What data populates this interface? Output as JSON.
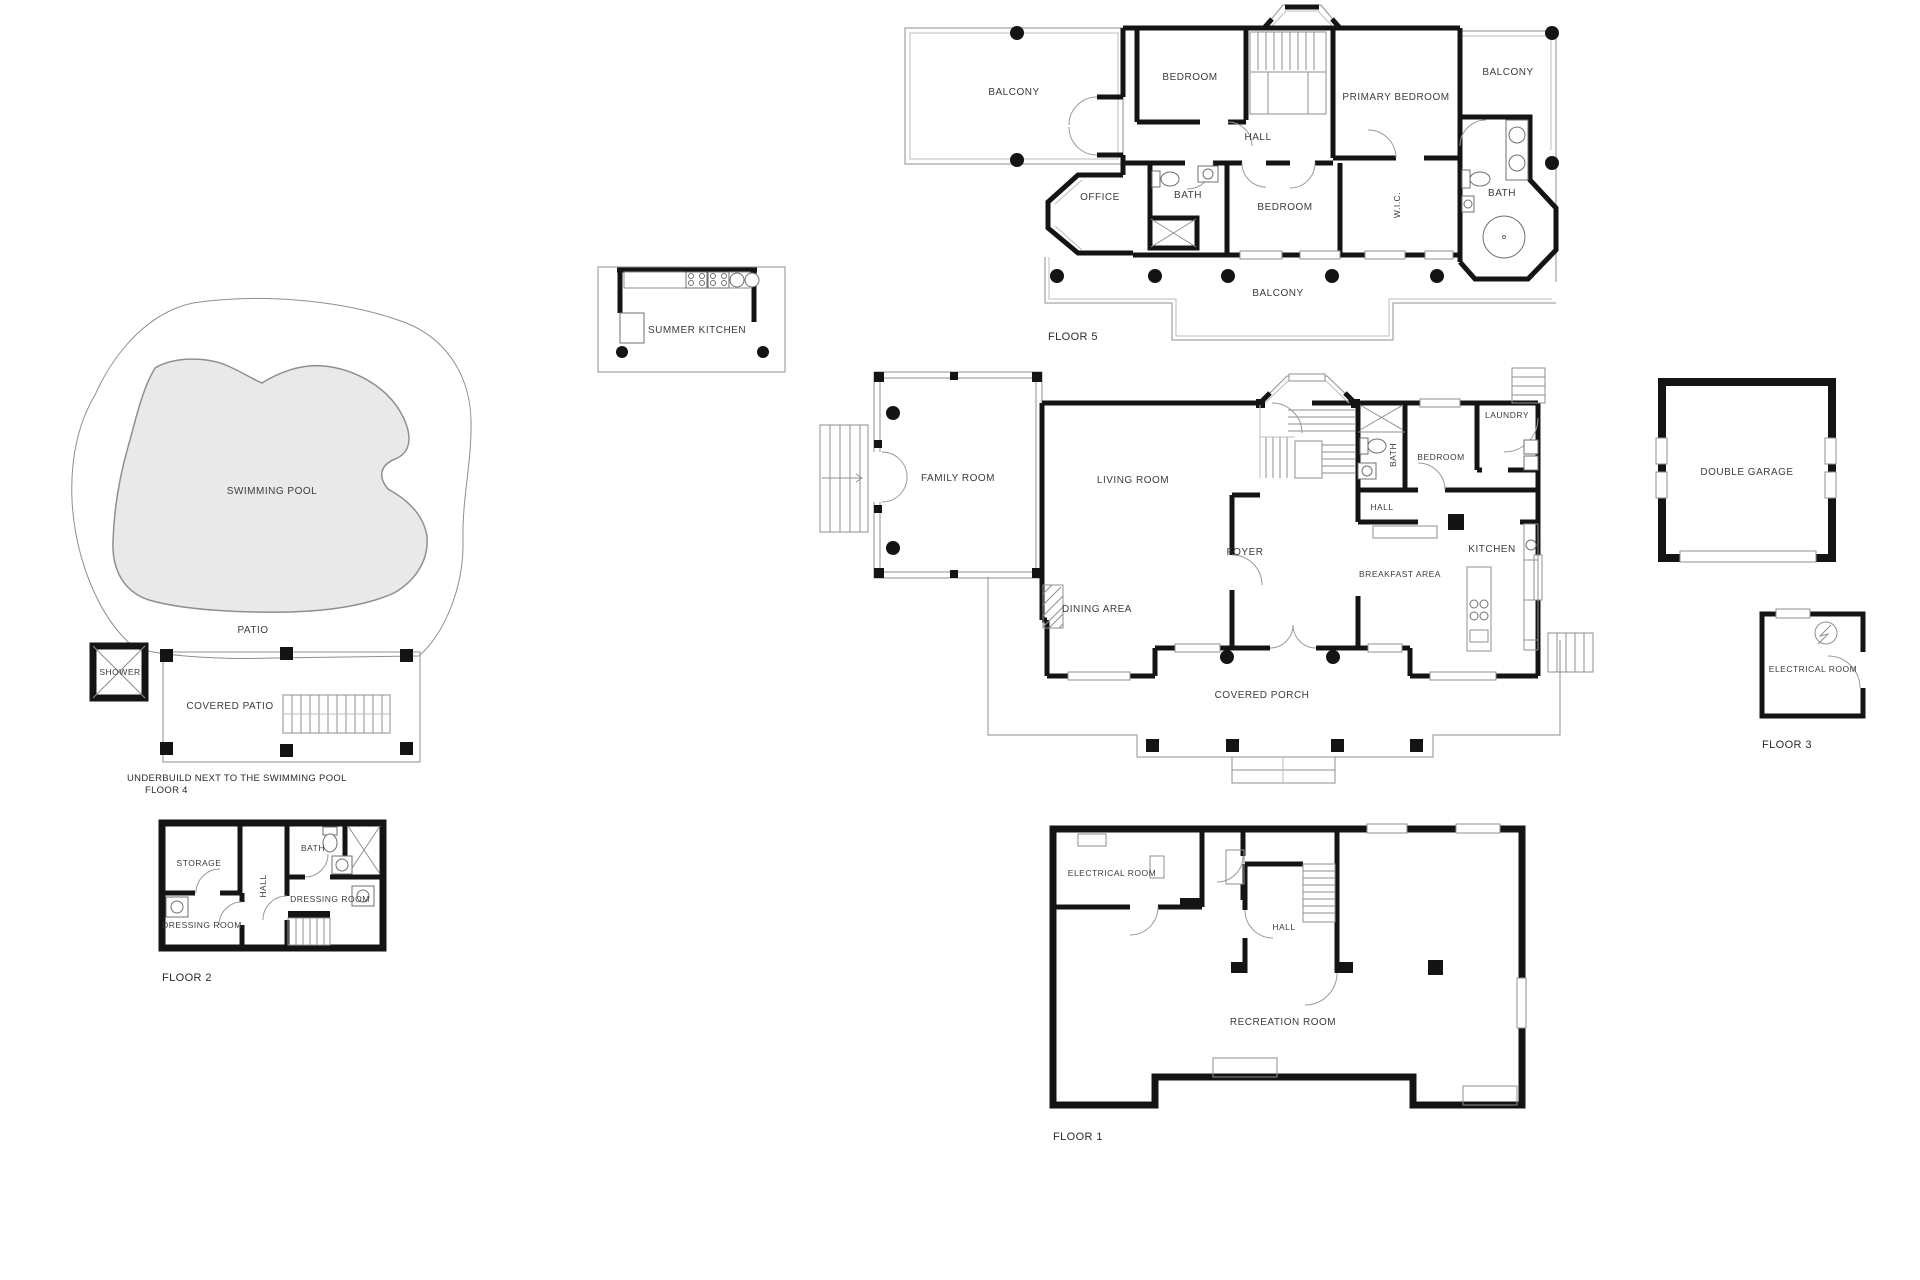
{
  "page": {
    "background": "#ffffff"
  },
  "colors": {
    "wall": "#141414",
    "thin_line": "#8f8f8f",
    "pool_fill": "#e9e9e9",
    "label": "#3c3c3c"
  },
  "floors": {
    "floor5": {
      "name": "FLOOR 5",
      "rooms": {
        "balcony_left": "BALCONY",
        "bedroom_top": "BEDROOM",
        "primary_bedroom": "PRIMARY BEDROOM",
        "balcony_right": "BALCONY",
        "hall": "HALL",
        "office": "OFFICE",
        "bath_left": "BATH",
        "bedroom_lower": "BEDROOM",
        "wic": "W.I.C.",
        "bath_right": "BATH",
        "balcony_bottom": "BALCONY"
      }
    },
    "summer_kitchen": {
      "rooms": {
        "summer_kitchen": "SUMMER KITCHEN"
      }
    },
    "pool_area": {
      "name": "FLOOR 4",
      "caption": "UNDERBUILD NEXT TO THE SWIMMING POOL",
      "rooms": {
        "swimming_pool": "SWIMMING POOL",
        "patio": "PATIO",
        "shower": "SHOWER",
        "covered_patio": "COVERED PATIO"
      }
    },
    "floor2": {
      "name": "FLOOR 2",
      "rooms": {
        "storage": "STORAGE",
        "bath": "BATH",
        "hall": "HALL",
        "dressing_room_left": "DRESSING ROOM",
        "dressing_room_right": "DRESSING ROOM"
      }
    },
    "main_floor": {
      "rooms": {
        "family_room": "FAMILY ROOM",
        "living_room": "LIVING ROOM",
        "dining_area": "DINING AREA",
        "foyer": "FOYER",
        "hall": "HALL",
        "bath": "BATH",
        "bedroom": "BEDROOM",
        "laundry": "LAUNDRY",
        "kitchen": "KITCHEN",
        "breakfast_area": "BREAKFAST AREA",
        "covered_porch": "COVERED PORCH"
      }
    },
    "floor3": {
      "name": "FLOOR 3",
      "rooms": {
        "double_garage": "DOUBLE GARAGE",
        "electrical_room": "ELECTRICAL ROOM"
      }
    },
    "floor1": {
      "name": "FLOOR 1",
      "rooms": {
        "electrical_room": "ELECTRICAL ROOM",
        "hall": "HALL",
        "recreation_room": "RECREATION ROOM"
      }
    }
  }
}
